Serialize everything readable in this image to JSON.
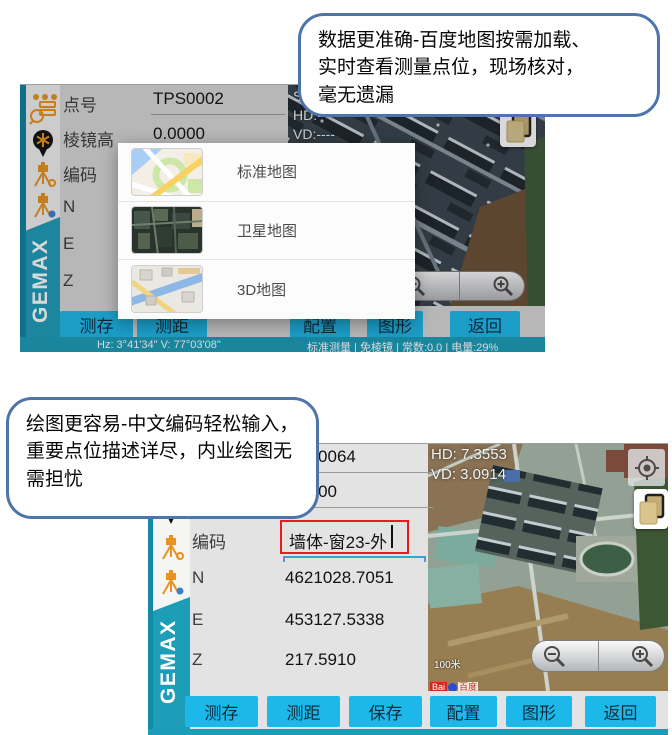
{
  "callouts": {
    "top": "数据更准确-百度地图按需加载、\n实时查看测量点位，现场核对，\n毫无遗漏",
    "bottom": "绘图更容易-中文编码轻松输入，\n重要点位描述详尽，内业绘图无\n需担忧"
  },
  "brand": "GEMAX",
  "sidebar_icons": [
    "overflow-menu",
    "point-search",
    "map-pin",
    "station-setup",
    "station-orientation"
  ],
  "screen1": {
    "fields": [
      {
        "label": "点号",
        "value": "TPS0002"
      },
      {
        "label": "棱镜高",
        "value": "0.0000"
      },
      {
        "label": "编码",
        "value": ""
      },
      {
        "label": "N",
        "value": ""
      },
      {
        "label": "E",
        "value": ""
      },
      {
        "label": "Z",
        "value": ""
      }
    ],
    "readout": {
      "sd": "SD:----",
      "hd": "HD:----",
      "vd": "VD:----"
    },
    "popup": [
      {
        "label": "标准地图"
      },
      {
        "label": "卫星地图"
      },
      {
        "label": "3D地图"
      }
    ],
    "buttons": [
      "测存",
      "测距",
      "配置",
      "图形",
      "返回"
    ],
    "status_left": "Hz: 3°41'34\"  V: 77°03'08\"",
    "status_right": "标准测量 | 免棱镜 | 常数:0.0 | 电量:29%"
  },
  "screen2": {
    "fields": [
      {
        "label": "点号",
        "value": "TPS0064"
      },
      {
        "label": "棱镜高",
        "value": "0.0000"
      },
      {
        "label": "编码",
        "value": "墙体-窗23-外"
      },
      {
        "label": "N",
        "value": "4621028.7051"
      },
      {
        "label": "E",
        "value": "453127.5338"
      },
      {
        "label": "Z",
        "value": "217.5910"
      }
    ],
    "readout": {
      "hd": "HD: 7.3553",
      "vd": "VD: 3.0914"
    },
    "scale": "100米",
    "attribution": {
      "latin": "Bai",
      "cn": "百度"
    },
    "buttons": [
      "测存",
      "测距",
      "保存",
      "配置",
      "图形",
      "返回"
    ]
  }
}
